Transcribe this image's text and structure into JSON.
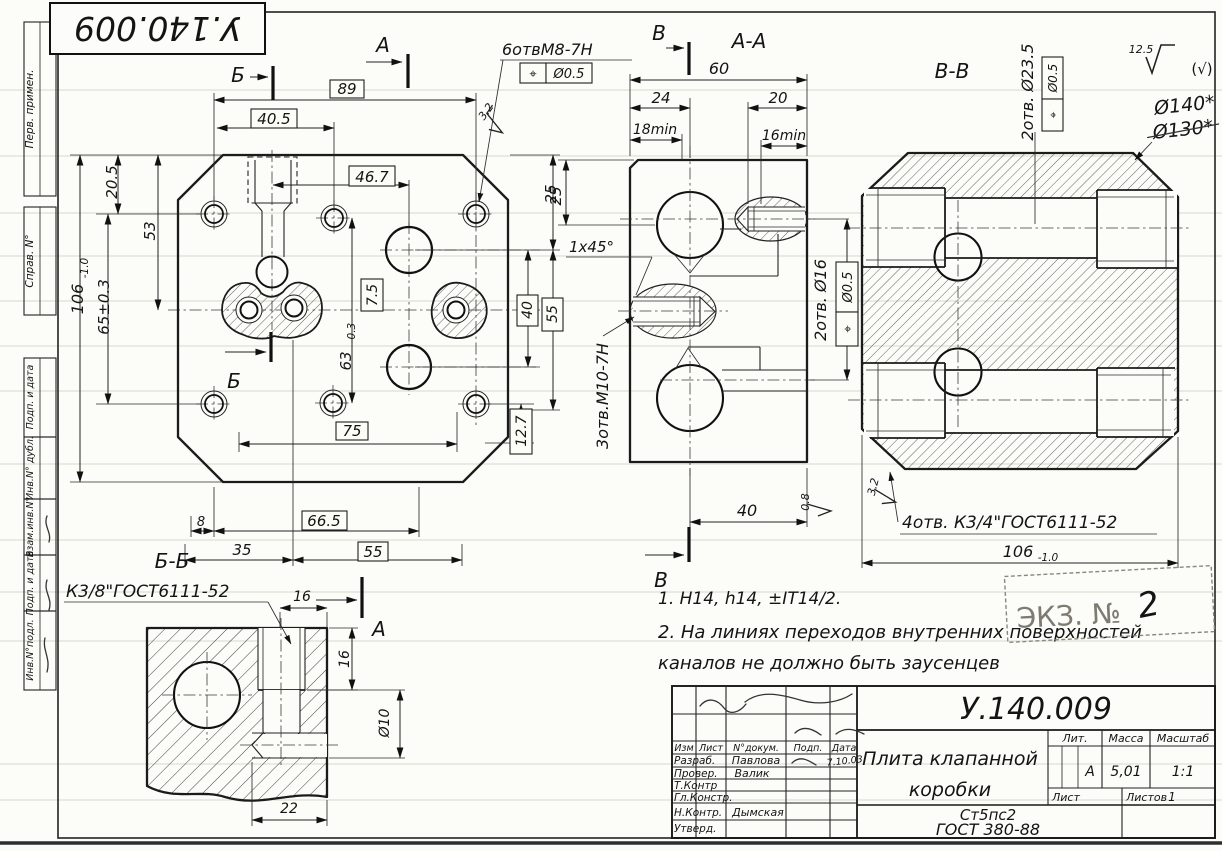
{
  "sheet": {
    "code_stamp": "У.140.009"
  },
  "symbols": {
    "pos": "⌖",
    "paren_check": "(√)"
  },
  "roughness": {
    "general": "12.5",
    "chamfer_main": "3.2",
    "bore_mid": "0.8",
    "corner_right": "3.2"
  },
  "sections": {
    "a": "А",
    "b": "Б",
    "v": "В",
    "aa": "А-А",
    "bb": "Б-Б",
    "vv": "В-В"
  },
  "main": {
    "d89": "89",
    "d40_5": "40.5",
    "d46_7": "46.7",
    "d20_5": "20.5",
    "d53": "53",
    "d106": "106",
    "d106_tol": "-1.0",
    "d65": "65±0.3",
    "d7_5": "7.5",
    "d63": "63",
    "d63_tol": "-0.3",
    "d40": "40",
    "d55": "55",
    "d25": "25",
    "d12_7": "12.7",
    "d75": "75",
    "d8": "8",
    "d66_5": "66.5",
    "d35": "35",
    "d55b": "55",
    "holes_m8": "6отвМ8-7Н",
    "pos_tol": "Ø0.5"
  },
  "aa": {
    "d60": "60",
    "d24": "24",
    "d20": "20",
    "d18min": "18min",
    "d16min": "16min",
    "d25": "25",
    "chamfer": "1x45°",
    "d40": "40",
    "thread_m10": "3отв.М10-7Н",
    "holes_16": "2отв. Ø16",
    "pos_tol": "Ø0.5"
  },
  "vv": {
    "holes_23": "2отв. Ø23.5",
    "pos_tol": "Ø0.5",
    "holes_k34": "4отв. К3/4\"ГОСТ6111-52",
    "d106": "106",
    "d106_tol": "-1.0",
    "hw_140": "Ø140*",
    "hw_130": "Ø130*"
  },
  "bb": {
    "thread": "К3/8\"ГОСТ6111-52",
    "d16a": "16",
    "d16b": "16",
    "d10": "Ø10",
    "d22": "22"
  },
  "notes": {
    "l1": "1.  Н14, h14, ±IT14/2.",
    "l2": "2. На линиях переходов  внутренних  поверхностей",
    "l3": "каналов  не  должно  быть  заусенцев"
  },
  "ekz": {
    "label": "ЭКЗ. №",
    "num": "2"
  },
  "tb": {
    "code": "У.140.009",
    "name1": "Плита  клапанной",
    "name2": "коробки",
    "mat1": "Ст5пс2",
    "mat2": "ГОСТ 380-88",
    "h_lit": "Лит.",
    "h_massa": "Масса",
    "h_masshtab": "Масштаб",
    "lit": "А",
    "massa": "5,01",
    "masshtab": "1:1",
    "h_list": "Лист",
    "h_listov": "Листов",
    "listov": "1",
    "c_izm": "Изм",
    "c_list": "Лист",
    "c_dok": "N°докум.",
    "c_podp": "Подп.",
    "c_data": "Дата",
    "r_razrab": "Разраб.",
    "v_razrab": "Павлова",
    "r_prover": "Провер.",
    "v_prover": "Валик",
    "r_tkontr": "Т.Контр",
    "r_glkonstr": "Гл.Констр.",
    "r_nkontr": "Н.Контр.",
    "v_nkontr": "Дымская",
    "r_utverd": "Утверд.",
    "date1": "7.10.03"
  },
  "margin": {
    "perv": "Перв. примен.",
    "sprav": "Справ. N°",
    "podp1": "Подп. и дата",
    "inv_dubl": "Инв.N° дубл.",
    "vzam": "Взам.инв.N°",
    "podp2": "Подп. и дата",
    "inv_podl": "Инв.N°подл."
  }
}
